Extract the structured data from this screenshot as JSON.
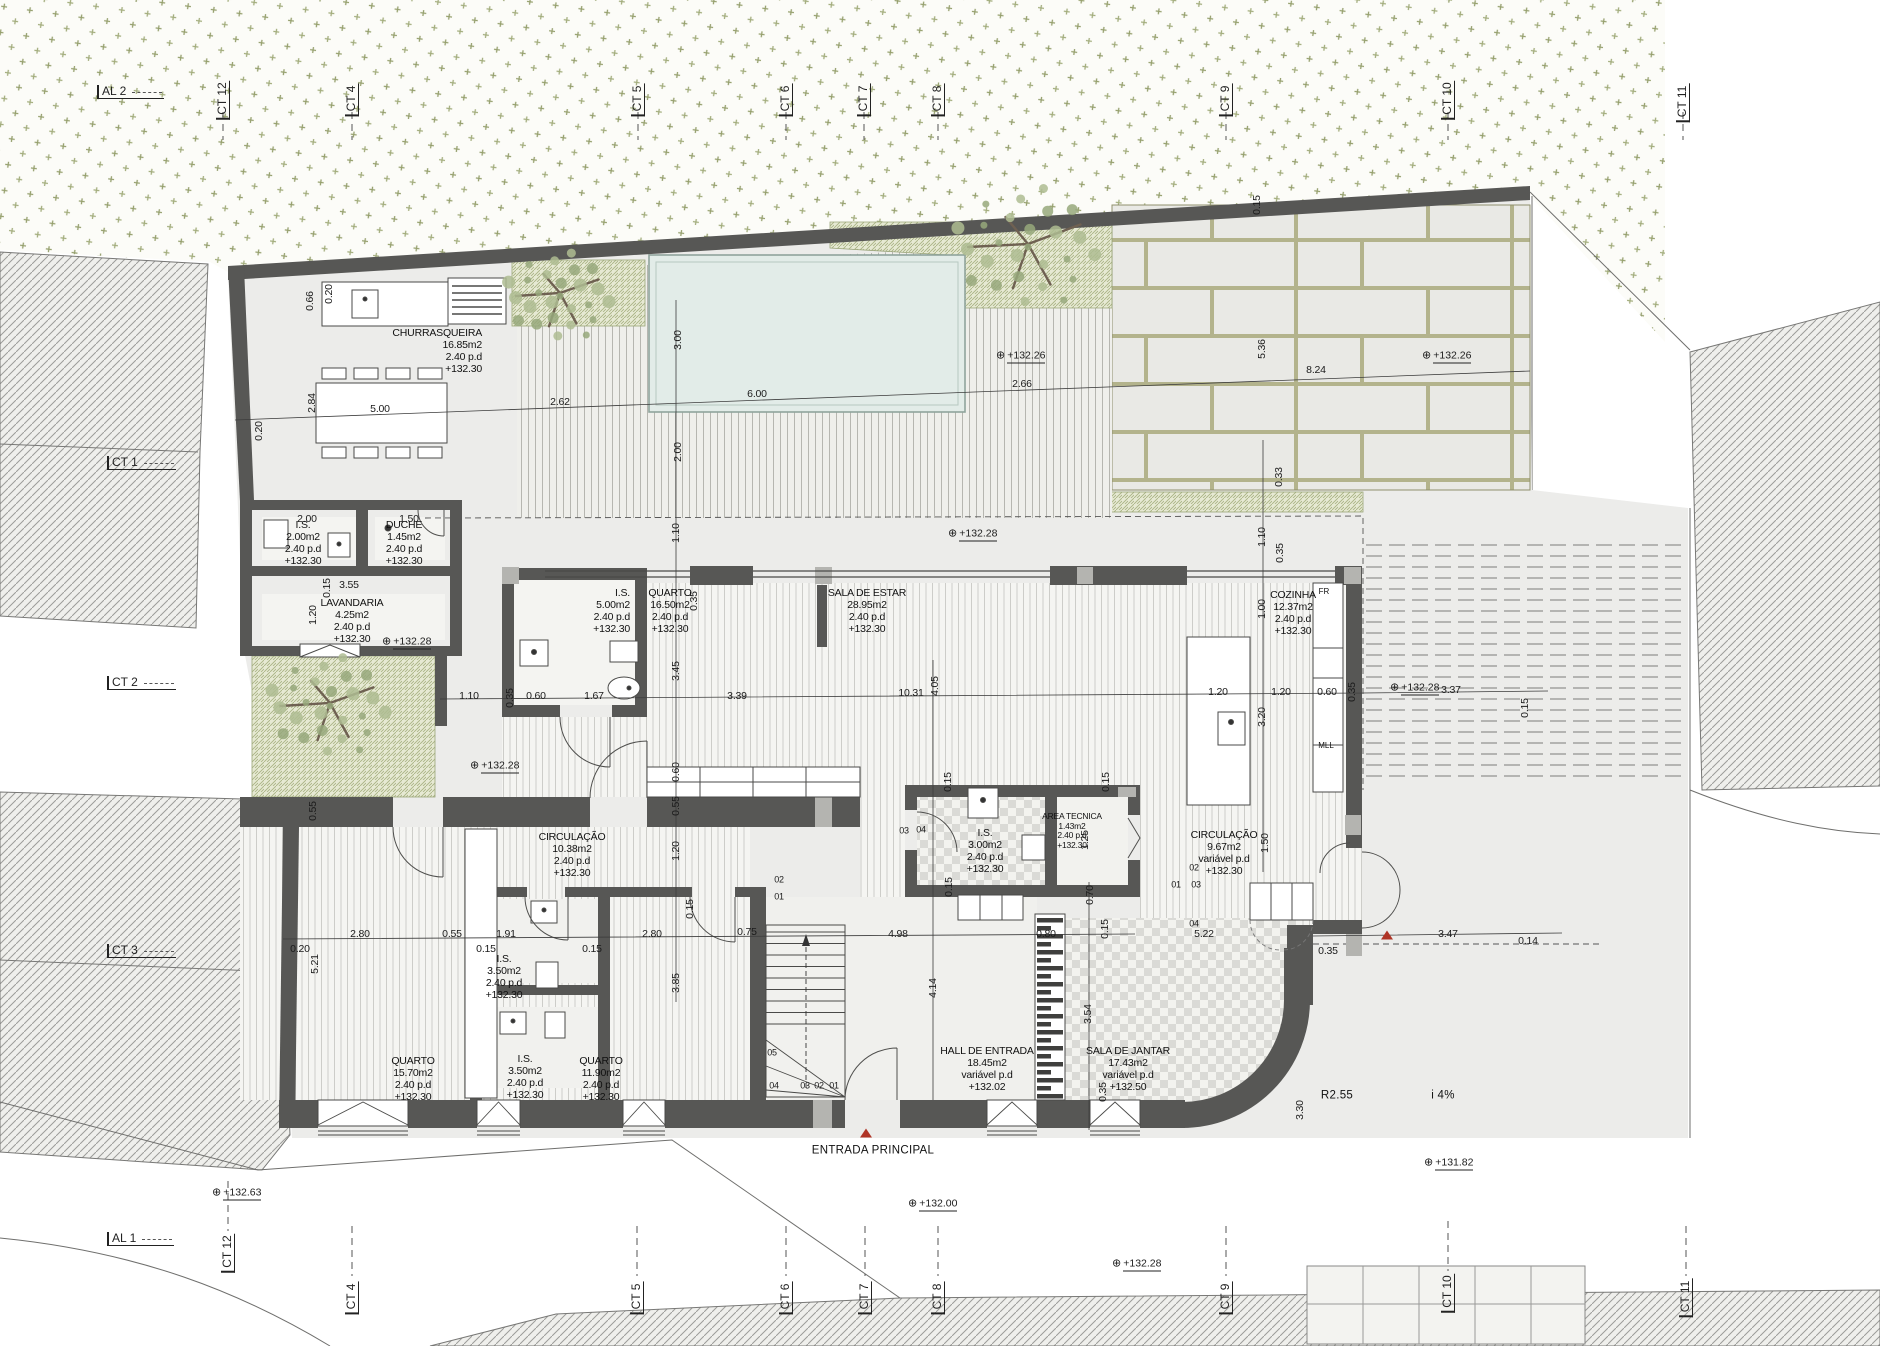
{
  "drawing": {
    "type": "architectural floor plan",
    "entrance_label": "ENTRADA PRINCIPAL"
  },
  "colors": {
    "wall": "#575755",
    "column": "#b4b4b0",
    "pool": "#e2ece8",
    "vegetation": "#96a06e",
    "grass_bg": "#e6e9d3",
    "red_marker": "#b03426",
    "paper": "#ffffff",
    "plot": "#ececea"
  },
  "rooms": [
    {
      "id": "churrasqueira",
      "lines": [
        "CHURRASQUEIRA",
        "16.85m2",
        "2.40 p.d",
        "+132.30"
      ],
      "x": 482,
      "y": 328,
      "align": "right"
    },
    {
      "id": "is-2",
      "lines": [
        "I.S.",
        "2.00m2",
        "2.40 p.d",
        "+132.30"
      ],
      "x": 303,
      "y": 520
    },
    {
      "id": "duche",
      "lines": [
        "DUCHE",
        "1.45m2",
        "2.40 p.d",
        "+132.30"
      ],
      "x": 404,
      "y": 520
    },
    {
      "id": "lavandaria",
      "lines": [
        "LAVANDARIA",
        "4.25m2",
        "2.40 p.d",
        "+132.30"
      ],
      "x": 352,
      "y": 598
    },
    {
      "id": "is-5",
      "lines": [
        "I.S.",
        "5.00m2",
        "2.40 p.d",
        "+132.30"
      ],
      "x": 630,
      "y": 588,
      "align": "right"
    },
    {
      "id": "quarto-16",
      "lines": [
        "QUARTO",
        "16.50m2",
        "2.40 p.d",
        "+132.30"
      ],
      "x": 670,
      "y": 588
    },
    {
      "id": "sala-de-estar",
      "lines": [
        "SALA DE ESTAR",
        "28.95m2",
        "2.40 p.d",
        "+132.30"
      ],
      "x": 867,
      "y": 588
    },
    {
      "id": "cozinha",
      "lines": [
        "COZINHA",
        "12.37m2",
        "2.40 p.d",
        "+132.30"
      ],
      "x": 1293,
      "y": 590
    },
    {
      "id": "circulacao-10",
      "lines": [
        "CIRCULAÇÃO",
        "10.38m2",
        "2.40 p.d",
        "+132.30"
      ],
      "x": 572,
      "y": 832
    },
    {
      "id": "is-3",
      "lines": [
        "I.S.",
        "3.00m2",
        "2.40 p.d",
        "+132.30"
      ],
      "x": 985,
      "y": 828
    },
    {
      "id": "area-tecnica",
      "lines": [
        "AREA TECNICA",
        "1.43m2",
        "2.40 p.d",
        "+132.30"
      ],
      "x": 1072,
      "y": 812,
      "small": true
    },
    {
      "id": "circulacao-9",
      "lines": [
        "CIRCULAÇÃO",
        "9.67m2",
        "variável p.d",
        "+132.30"
      ],
      "x": 1224,
      "y": 830
    },
    {
      "id": "is-35-a",
      "lines": [
        "I.S.",
        "3.50m2",
        "2.40 p.d",
        "+132.30"
      ],
      "x": 504,
      "y": 954
    },
    {
      "id": "quarto-15",
      "lines": [
        "QUARTO",
        "15.70m2",
        "2.40 p.d",
        "+132.30"
      ],
      "x": 413,
      "y": 1056
    },
    {
      "id": "is-35-b",
      "lines": [
        "I.S.",
        "3.50m2",
        "2.40 p.d",
        "+132.30"
      ],
      "x": 525,
      "y": 1054
    },
    {
      "id": "quarto-11",
      "lines": [
        "QUARTO",
        "11.90m2",
        "2.40 p.d",
        "+132.30"
      ],
      "x": 601,
      "y": 1056
    },
    {
      "id": "hall-de-entrada",
      "lines": [
        "HALL DE ENTRADA",
        "18.45m2",
        "variável p.d",
        "+132.02"
      ],
      "x": 987,
      "y": 1046
    },
    {
      "id": "sala-de-jantar",
      "lines": [
        "SALA DE JANTAR",
        "17.43m2",
        "variável p.d",
        "+132.50"
      ],
      "x": 1128,
      "y": 1046
    }
  ],
  "dims": [
    {
      "t": "0.20",
      "x": 259,
      "y": 431,
      "r": 1
    },
    {
      "t": "5.00",
      "x": 380,
      "y": 409
    },
    {
      "t": "2.62",
      "x": 560,
      "y": 402
    },
    {
      "t": "6.00",
      "x": 757,
      "y": 394
    },
    {
      "t": "2.66",
      "x": 1022,
      "y": 384
    },
    {
      "t": "8.24",
      "x": 1316,
      "y": 370
    },
    {
      "t": "2.84",
      "x": 312,
      "y": 403,
      "r": 1
    },
    {
      "t": "0.66",
      "x": 310,
      "y": 301,
      "r": 1
    },
    {
      "t": "0.20",
      "x": 329,
      "y": 294,
      "r": 1
    },
    {
      "t": "3.00",
      "x": 678,
      "y": 340,
      "r": 1
    },
    {
      "t": "2.00",
      "x": 678,
      "y": 452,
      "r": 1
    },
    {
      "t": "1.10",
      "x": 676,
      "y": 533,
      "r": 1
    },
    {
      "t": "5.36",
      "x": 1262,
      "y": 349,
      "r": 1
    },
    {
      "t": "0.33",
      "x": 1279,
      "y": 477,
      "r": 1
    },
    {
      "t": "0.15",
      "x": 1257,
      "y": 205,
      "r": 1
    },
    {
      "t": "2.00",
      "x": 307,
      "y": 519
    },
    {
      "t": "1.50",
      "x": 409,
      "y": 519
    },
    {
      "t": "3.55",
      "x": 349,
      "y": 585
    },
    {
      "t": "0.15",
      "x": 327,
      "y": 588,
      "r": 1
    },
    {
      "t": "1.20",
      "x": 313,
      "y": 615,
      "r": 1
    },
    {
      "t": "1.10",
      "x": 469,
      "y": 696
    },
    {
      "t": "0.35",
      "x": 510,
      "y": 698,
      "r": 1
    },
    {
      "t": "0.60",
      "x": 536,
      "y": 696
    },
    {
      "t": "1.67",
      "x": 594,
      "y": 696
    },
    {
      "t": "3.39",
      "x": 737,
      "y": 696
    },
    {
      "t": "3.45",
      "x": 676,
      "y": 671,
      "r": 1
    },
    {
      "t": "0.35",
      "x": 694,
      "y": 601,
      "r": 1
    },
    {
      "t": "10.31",
      "x": 911,
      "y": 693
    },
    {
      "t": "4.05",
      "x": 935,
      "y": 686,
      "r": 1
    },
    {
      "t": "1.10",
      "x": 1262,
      "y": 537,
      "r": 1
    },
    {
      "t": "0.35",
      "x": 1280,
      "y": 553,
      "r": 1
    },
    {
      "t": "1.00",
      "x": 1262,
      "y": 609,
      "r": 1
    },
    {
      "t": "1.20",
      "x": 1218,
      "y": 692
    },
    {
      "t": "1.20",
      "x": 1281,
      "y": 692
    },
    {
      "t": "0.60",
      "x": 1327,
      "y": 692
    },
    {
      "t": "0.35",
      "x": 1352,
      "y": 692,
      "r": 1
    },
    {
      "t": "3.37",
      "x": 1451,
      "y": 690
    },
    {
      "t": "0.15",
      "x": 1525,
      "y": 708,
      "r": 1
    },
    {
      "t": "3.20",
      "x": 1262,
      "y": 717,
      "r": 1
    },
    {
      "t": "1.50",
      "x": 1265,
      "y": 843,
      "r": 1
    },
    {
      "t": "0.60",
      "x": 676,
      "y": 772,
      "r": 1
    },
    {
      "t": "0.55",
      "x": 676,
      "y": 806,
      "r": 1
    },
    {
      "t": "1.20",
      "x": 676,
      "y": 851,
      "r": 1
    },
    {
      "t": "0.15",
      "x": 690,
      "y": 909,
      "r": 1
    },
    {
      "t": "3.85",
      "x": 676,
      "y": 983,
      "r": 1
    },
    {
      "t": "0.55",
      "x": 313,
      "y": 811,
      "r": 1
    },
    {
      "t": "0.15",
      "x": 948,
      "y": 782,
      "r": 1
    },
    {
      "t": "0.15",
      "x": 1106,
      "y": 782,
      "r": 1
    },
    {
      "t": "0.15",
      "x": 949,
      "y": 887,
      "r": 1
    },
    {
      "t": "0.70",
      "x": 1090,
      "y": 895,
      "r": 1
    },
    {
      "t": "1.25",
      "x": 1085,
      "y": 840,
      "r": 1
    },
    {
      "t": "0.15",
      "x": 1105,
      "y": 929,
      "r": 1
    },
    {
      "t": "0.20",
      "x": 300,
      "y": 949
    },
    {
      "t": "2.80",
      "x": 360,
      "y": 934
    },
    {
      "t": "0.55",
      "x": 452,
      "y": 934
    },
    {
      "t": "1.91",
      "x": 506,
      "y": 934
    },
    {
      "t": "0.15",
      "x": 486,
      "y": 949
    },
    {
      "t": "0.15",
      "x": 592,
      "y": 949
    },
    {
      "t": "2.80",
      "x": 652,
      "y": 934
    },
    {
      "t": "0.75",
      "x": 747,
      "y": 932
    },
    {
      "t": "4.98",
      "x": 898,
      "y": 934
    },
    {
      "t": "0.80",
      "x": 1046,
      "y": 934
    },
    {
      "t": "5.22",
      "x": 1204,
      "y": 934
    },
    {
      "t": "0.35",
      "x": 1328,
      "y": 951
    },
    {
      "t": "3.47",
      "x": 1448,
      "y": 934
    },
    {
      "t": "0.14",
      "x": 1528,
      "y": 941
    },
    {
      "t": "5.21",
      "x": 315,
      "y": 964,
      "r": 1
    },
    {
      "t": "4.14",
      "x": 933,
      "y": 988,
      "r": 1
    },
    {
      "t": "3.54",
      "x": 1088,
      "y": 1014,
      "r": 1
    },
    {
      "t": "0.35",
      "x": 1103,
      "y": 1092,
      "r": 1
    },
    {
      "t": "3.30",
      "x": 1300,
      "y": 1110,
      "r": 1
    }
  ],
  "door_numbers": [
    {
      "t": "02",
      "x": 779,
      "y": 880
    },
    {
      "t": "01",
      "x": 779,
      "y": 897
    },
    {
      "t": "03",
      "x": 904,
      "y": 831
    },
    {
      "t": "04",
      "x": 921,
      "y": 830
    },
    {
      "t": "02",
      "x": 1194,
      "y": 868
    },
    {
      "t": "01",
      "x": 1176,
      "y": 885
    },
    {
      "t": "03",
      "x": 1196,
      "y": 885
    },
    {
      "t": "04",
      "x": 1194,
      "y": 924
    },
    {
      "t": "05",
      "x": 772,
      "y": 1053
    },
    {
      "t": "04",
      "x": 774,
      "y": 1086
    },
    {
      "t": "03",
      "x": 805,
      "y": 1086
    },
    {
      "t": "02",
      "x": 819,
      "y": 1086
    },
    {
      "t": "01",
      "x": 834,
      "y": 1086
    }
  ],
  "levels": [
    {
      "v": "+132.26",
      "x": 996,
      "y": 356
    },
    {
      "v": "+132.26",
      "x": 1422,
      "y": 356
    },
    {
      "v": "+132.28",
      "x": 948,
      "y": 534
    },
    {
      "v": "+132.28",
      "x": 382,
      "y": 642
    },
    {
      "v": "+132.28",
      "x": 470,
      "y": 766
    },
    {
      "v": "+132.28",
      "x": 1390,
      "y": 688
    },
    {
      "v": "+132.00",
      "x": 908,
      "y": 1204
    },
    {
      "v": "+132.28",
      "x": 1112,
      "y": 1264
    },
    {
      "v": "+131.82",
      "x": 1424,
      "y": 1163
    },
    {
      "v": "+132.63",
      "x": 212,
      "y": 1193
    }
  ],
  "grid": {
    "top": [
      {
        "t": "AL 2",
        "x": 97,
        "y": 92,
        "o": "h"
      },
      {
        "t": "CT 12",
        "x": 223,
        "y": 100,
        "o": "v"
      },
      {
        "t": "CT 4",
        "x": 352,
        "y": 100,
        "o": "v"
      },
      {
        "t": "CT 5",
        "x": 638,
        "y": 100,
        "o": "v"
      },
      {
        "t": "CT 6",
        "x": 786,
        "y": 100,
        "o": "v"
      },
      {
        "t": "CT 7",
        "x": 864,
        "y": 100,
        "o": "v"
      },
      {
        "t": "CT 8",
        "x": 938,
        "y": 100,
        "o": "v"
      },
      {
        "t": "CT 9",
        "x": 1226,
        "y": 100,
        "o": "v"
      },
      {
        "t": "CT 10",
        "x": 1448,
        "y": 100,
        "o": "v"
      },
      {
        "t": "CT 11",
        "x": 1683,
        "y": 103,
        "o": "v"
      }
    ],
    "bottom": [
      {
        "t": "CT 12",
        "x": 228,
        "y": 1253,
        "o": "v"
      },
      {
        "t": "CT 4",
        "x": 352,
        "y": 1298,
        "o": "v"
      },
      {
        "t": "CT 5",
        "x": 637,
        "y": 1298,
        "o": "v"
      },
      {
        "t": "CT 6",
        "x": 786,
        "y": 1298,
        "o": "v"
      },
      {
        "t": "CT 7",
        "x": 865,
        "y": 1298,
        "o": "v"
      },
      {
        "t": "CT 8",
        "x": 938,
        "y": 1298,
        "o": "v"
      },
      {
        "t": "CT 9",
        "x": 1226,
        "y": 1298,
        "o": "v"
      },
      {
        "t": "CT 10",
        "x": 1448,
        "y": 1293,
        "o": "v"
      },
      {
        "t": "CT 11",
        "x": 1686,
        "y": 1298,
        "o": "v"
      }
    ],
    "left": [
      {
        "t": "CT 1",
        "x": 107,
        "y": 463,
        "o": "h"
      },
      {
        "t": "CT 2",
        "x": 107,
        "y": 683,
        "o": "h"
      },
      {
        "t": "CT 3",
        "x": 107,
        "y": 951,
        "o": "h"
      },
      {
        "t": "AL 1",
        "x": 107,
        "y": 1239,
        "o": "h"
      }
    ]
  },
  "annotations": [
    {
      "t": "ENTRADA PRINCIPAL",
      "x": 873,
      "y": 1151
    },
    {
      "t": "i 4%",
      "x": 1443,
      "y": 1096
    },
    {
      "t": "R2.55",
      "x": 1337,
      "y": 1096,
      "rot": 45
    },
    {
      "t": "FR",
      "x": 1324,
      "y": 592,
      "small": true
    },
    {
      "t": "MLL",
      "x": 1326,
      "y": 746,
      "small": true
    }
  ],
  "markers": [
    {
      "name": "entrance-triangle",
      "x": 866,
      "y": 1133
    },
    {
      "name": "side-entrance-triangle",
      "x": 1387,
      "y": 935
    }
  ]
}
